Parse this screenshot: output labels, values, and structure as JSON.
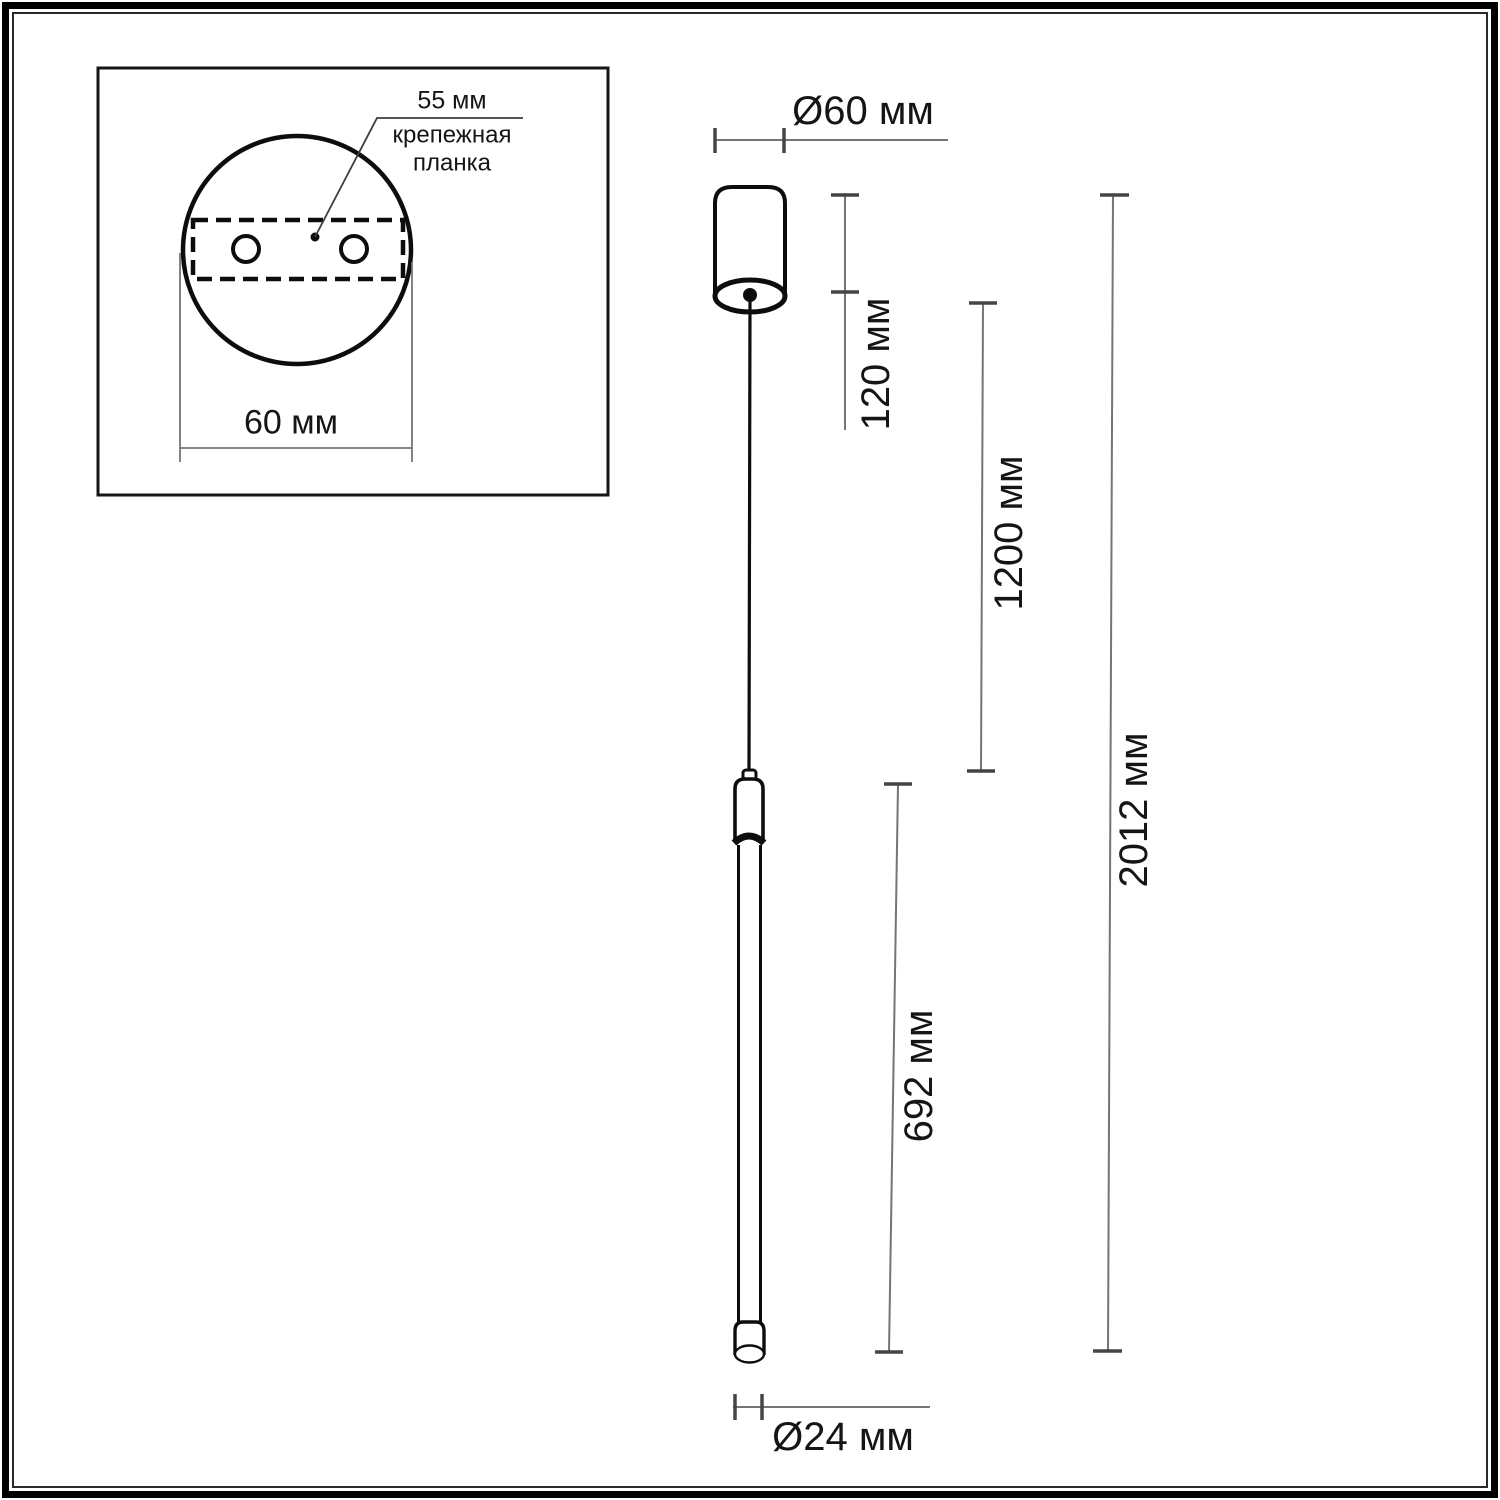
{
  "title": "Pendant light fixture dimensional drawing",
  "colors": {
    "background": "#ffffff",
    "outline": "#0d0d0d",
    "dim_line": "#757575",
    "dim_tick": "#454545",
    "text": "#151515"
  },
  "inset": {
    "hole_spacing_label": "55 мм",
    "mount_plate_label": "крепежная планка",
    "plate_width_label": "60 мм"
  },
  "dims": {
    "canopy_diameter": "Ø60 мм",
    "canopy_height": "120 мм",
    "suspension_length": "1200 мм",
    "total_height": "2012 мм",
    "tube_length": "692 мм",
    "tube_diameter": "Ø24 мм"
  }
}
